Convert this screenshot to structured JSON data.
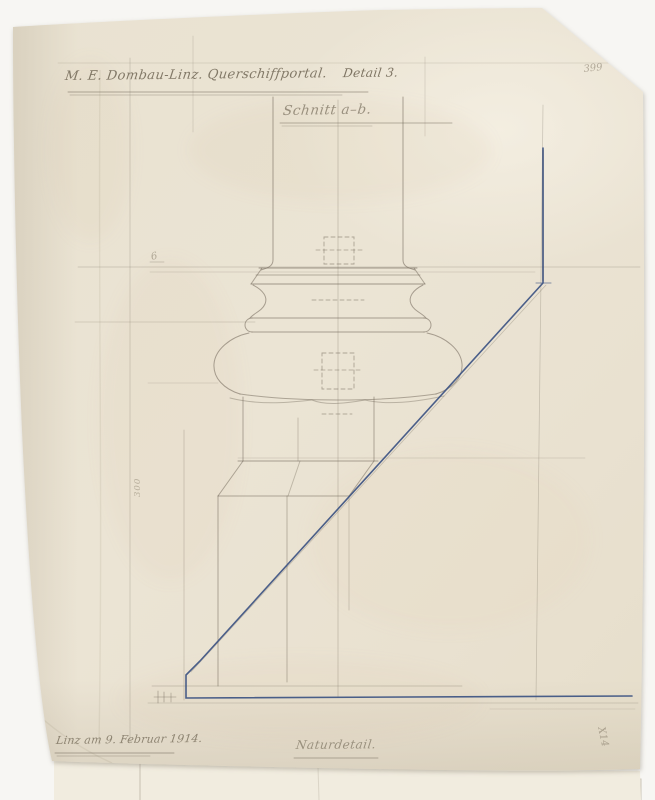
{
  "page": {
    "background_color": "#f7f6f3",
    "paper_color": "#eae3d3",
    "under_sheet_color": "#f1ecdf",
    "pencil_color": "#6d6355",
    "ink_color": "#3c5282"
  },
  "inscriptions": {
    "title": "M. E. Dombau-Linz. Querschiffportal.",
    "title_detail": "Detail 3.",
    "section_label": "Schnitt a–b.",
    "date_line": "Linz am 9. Februar 1914.",
    "scale_label": "Naturdetail.",
    "sheet_number": "399",
    "edge_mark": "X14",
    "margin_mark": "6",
    "margin_measure": "300"
  }
}
